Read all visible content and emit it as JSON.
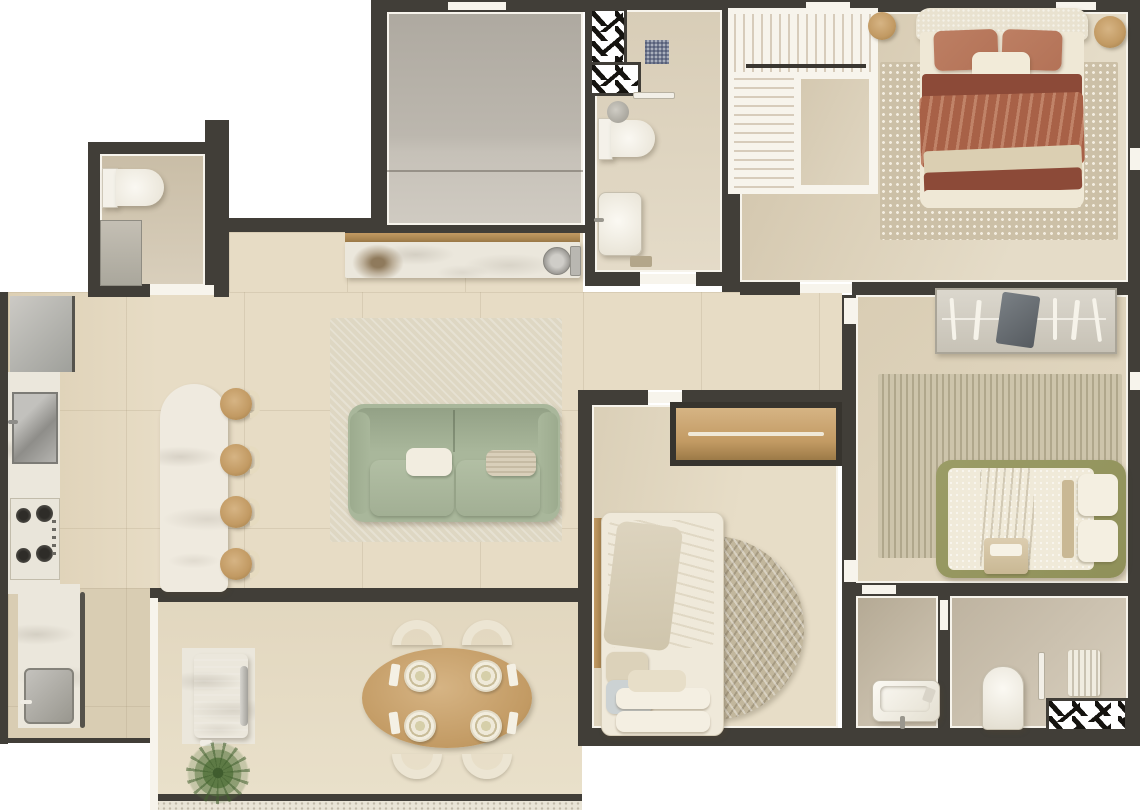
{
  "meta": {
    "title": "Apartment Floor Plan — 3D Top View",
    "type": "architectural floor plan render",
    "canvas": {
      "width": 1140,
      "height": 810
    }
  },
  "colors": {
    "white": "#ffffff",
    "wall": "#413e38",
    "hatch": "#15130f",
    "trim": "#f7f4ec",
    "floor": "#e7dcc5",
    "floorDark": "#d9cdb3",
    "marble": "#ebe7dc",
    "wood": "#c29a63",
    "woodLight": "#d6b484",
    "woodDark": "#9c7a47",
    "sage": "#a9b79b",
    "sageDark": "#93a186",
    "rugLiving": "#ded7c3",
    "rugDots": "#ccc0a7",
    "dotWhite": "#f3ede0",
    "cream": "#ece5d3",
    "creamDark": "#dcd2bd",
    "terracotta": "#b37257",
    "rust": "#a86147",
    "maroon": "#8c4a38",
    "oliveGreen": "#8f9059",
    "stripeA": "#cdc4ab",
    "stripeB": "#b0a78c",
    "herringA": "#c2b79d",
    "grillGray": "#93928d",
    "grillDark": "#76756f",
    "steel": "#aeadaa",
    "plantGreen": "#5d7a45",
    "plantDark": "#3f5c2e"
  },
  "rooms": [
    {
      "id": "entry-bathroom",
      "label": "guest bathroom (top-left)"
    },
    {
      "id": "gray-hall",
      "label": "gray tiled hall (top-center)"
    },
    {
      "id": "master-bathroom",
      "label": "bathroom with shower and shaft (top-center-right)"
    },
    {
      "id": "master-bedroom",
      "label": "master suite (top-right)"
    },
    {
      "id": "kitchen",
      "label": "kitchen strip (left)"
    },
    {
      "id": "living-room",
      "label": "open living room (center)"
    },
    {
      "id": "hallway",
      "label": "bedroom corridor (center-right)"
    },
    {
      "id": "balcony-dining",
      "label": "gourmet balcony with dining (bottom-center)"
    },
    {
      "id": "bedroom-3",
      "label": "bedroom with round rug (bottom-center-right)"
    },
    {
      "id": "bedroom-2",
      "label": "bedroom with striped rug (right)"
    },
    {
      "id": "wc-small",
      "label": "small washroom (bottom-right left)"
    },
    {
      "id": "bathroom-2",
      "label": "bathroom with shaft (bottom-right)"
    }
  ],
  "furniture": [
    {
      "id": "toilet-entry",
      "room": "entry-bathroom"
    },
    {
      "id": "vanity-entry",
      "room": "entry-bathroom"
    },
    {
      "id": "buffet-counter",
      "room": "living-room"
    },
    {
      "id": "buffet-sink",
      "room": "living-room"
    },
    {
      "id": "dry-plant",
      "room": "living-room"
    },
    {
      "id": "sofa",
      "room": "living-room"
    },
    {
      "id": "living-rug",
      "room": "living-room"
    },
    {
      "id": "fridge",
      "room": "kitchen"
    },
    {
      "id": "kitchen-sink",
      "room": "kitchen"
    },
    {
      "id": "cooktop",
      "room": "kitchen"
    },
    {
      "id": "laundry-sink",
      "room": "kitchen"
    },
    {
      "id": "island",
      "room": "kitchen"
    },
    {
      "id": "island-stools",
      "room": "kitchen",
      "count": 4
    },
    {
      "id": "grill-station",
      "room": "balcony-dining"
    },
    {
      "id": "potted-plant",
      "room": "balcony-dining"
    },
    {
      "id": "dining-table",
      "room": "balcony-dining",
      "seats": 4
    },
    {
      "id": "dining-chairs",
      "room": "balcony-dining",
      "count": 4
    },
    {
      "id": "shaft-hatch-top",
      "room": "master-bathroom"
    },
    {
      "id": "toilet-master",
      "room": "master-bathroom"
    },
    {
      "id": "vanity-master",
      "room": "master-bathroom"
    },
    {
      "id": "closet-L",
      "room": "master-bedroom"
    },
    {
      "id": "master-bed",
      "room": "master-bedroom"
    },
    {
      "id": "dotted-rug",
      "room": "master-bedroom"
    },
    {
      "id": "side-stools",
      "room": "master-bedroom",
      "count": 2
    },
    {
      "id": "wardrobe-shelf",
      "room": "bedroom-3"
    },
    {
      "id": "single-bed",
      "room": "bedroom-3"
    },
    {
      "id": "round-rug",
      "room": "bedroom-3"
    },
    {
      "id": "desk-shelf",
      "room": "bedroom-2"
    },
    {
      "id": "striped-rug",
      "room": "bedroom-2"
    },
    {
      "id": "olive-bed",
      "room": "bedroom-2"
    },
    {
      "id": "wash-basin",
      "room": "wc-small"
    },
    {
      "id": "toilet-2",
      "room": "bathroom-2"
    },
    {
      "id": "towel-rack",
      "room": "bathroom-2"
    },
    {
      "id": "shaft-hatch-bottom",
      "room": "bathroom-2"
    }
  ]
}
